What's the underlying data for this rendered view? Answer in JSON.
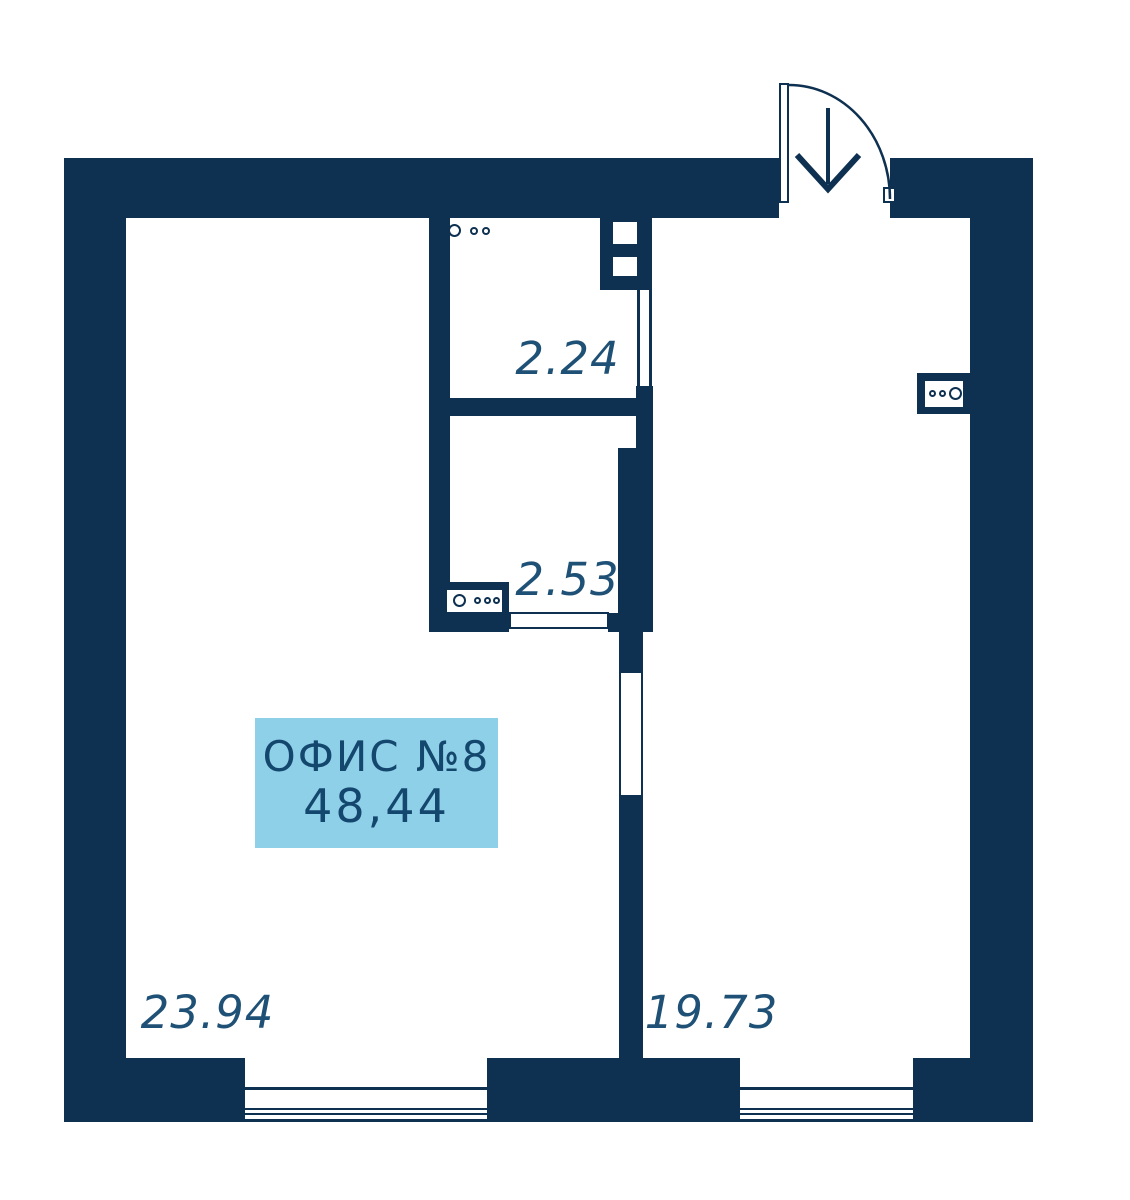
{
  "floorplan": {
    "title": "ОФИС №8",
    "title_area": "48,44",
    "rooms": [
      {
        "area": "23.94"
      },
      {
        "area": "19.73"
      },
      {
        "area": "2.24"
      },
      {
        "area": "2.53"
      }
    ],
    "colors": {
      "wall": "#0e3151",
      "label_box_bg": "#8fd0e9",
      "label_text": "#14476d",
      "area_text": "#1f5176"
    },
    "icons": {
      "entrance_arrow": "↓",
      "door_swing_arc": "quarter-arc",
      "meter_circles": "○ ○○"
    }
  }
}
